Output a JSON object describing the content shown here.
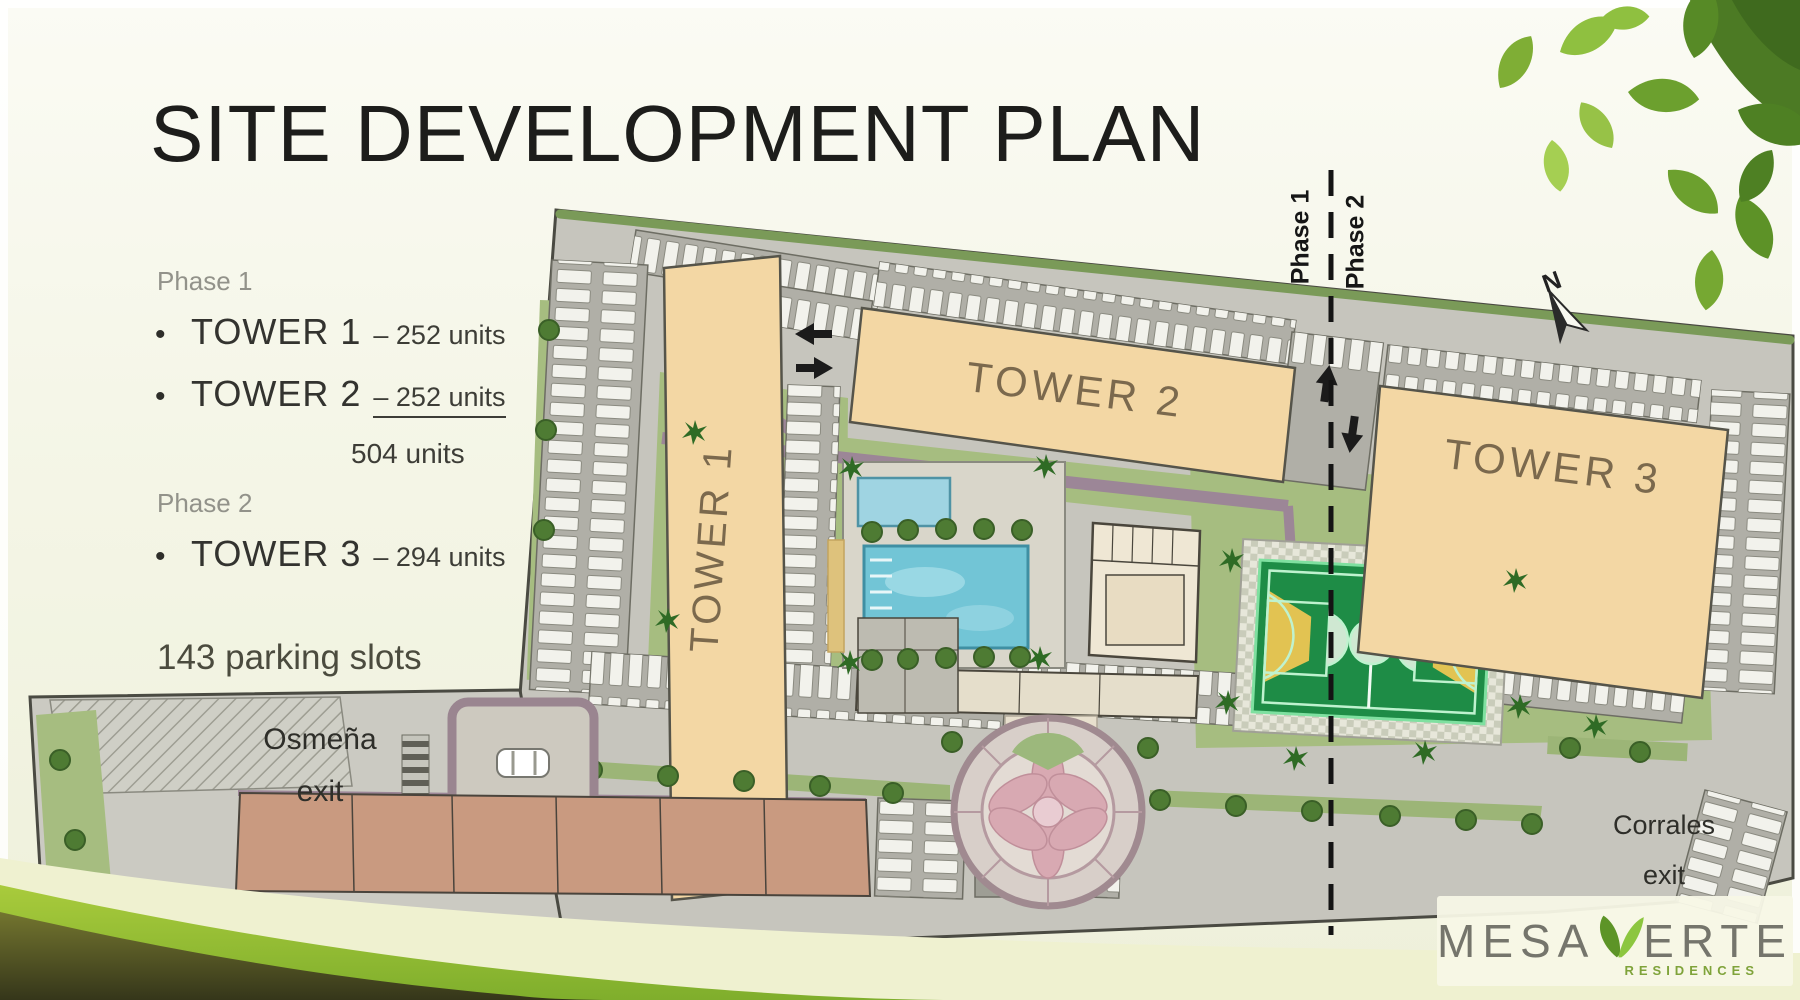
{
  "title": "SITE DEVELOPMENT PLAN",
  "legend": {
    "bullet": "•",
    "phase1": {
      "label": "Phase 1",
      "items": [
        {
          "name": "TOWER 1",
          "sep": "–",
          "units": "252 units"
        },
        {
          "name": "TOWER 2",
          "sep": "–",
          "units": "252 units"
        }
      ],
      "subtotal": "504 units"
    },
    "phase2": {
      "label": "Phase 2",
      "items": [
        {
          "name": "TOWER 3",
          "sep": "–",
          "units": "294 units"
        }
      ]
    },
    "parking_note": "143 parking slots"
  },
  "plan": {
    "tower1_label": "TOWER 1",
    "tower2_label": "TOWER 2",
    "tower3_label": "TOWER 3",
    "phase_divider": {
      "phase1": "Phase 1",
      "phase2": "Phase 2"
    },
    "west_exit": {
      "line1": "Osmeña",
      "line2": "exit"
    },
    "east_exit": {
      "line1": "Corrales",
      "line2": "exit"
    },
    "compass_n": "N"
  },
  "logo": {
    "name_left": "MESA",
    "name_right": "ERTE",
    "subtitle": "RESIDENCES"
  },
  "colors": {
    "tower_fill": "#f3d7a4",
    "pool_blue": "#72c5d6",
    "court_green": "#1e8c46",
    "court_yellow": "#e2c352",
    "lawn_green": "#a6bd80",
    "accent_green": "#8cc63f",
    "wave_olive": "#55581f"
  }
}
